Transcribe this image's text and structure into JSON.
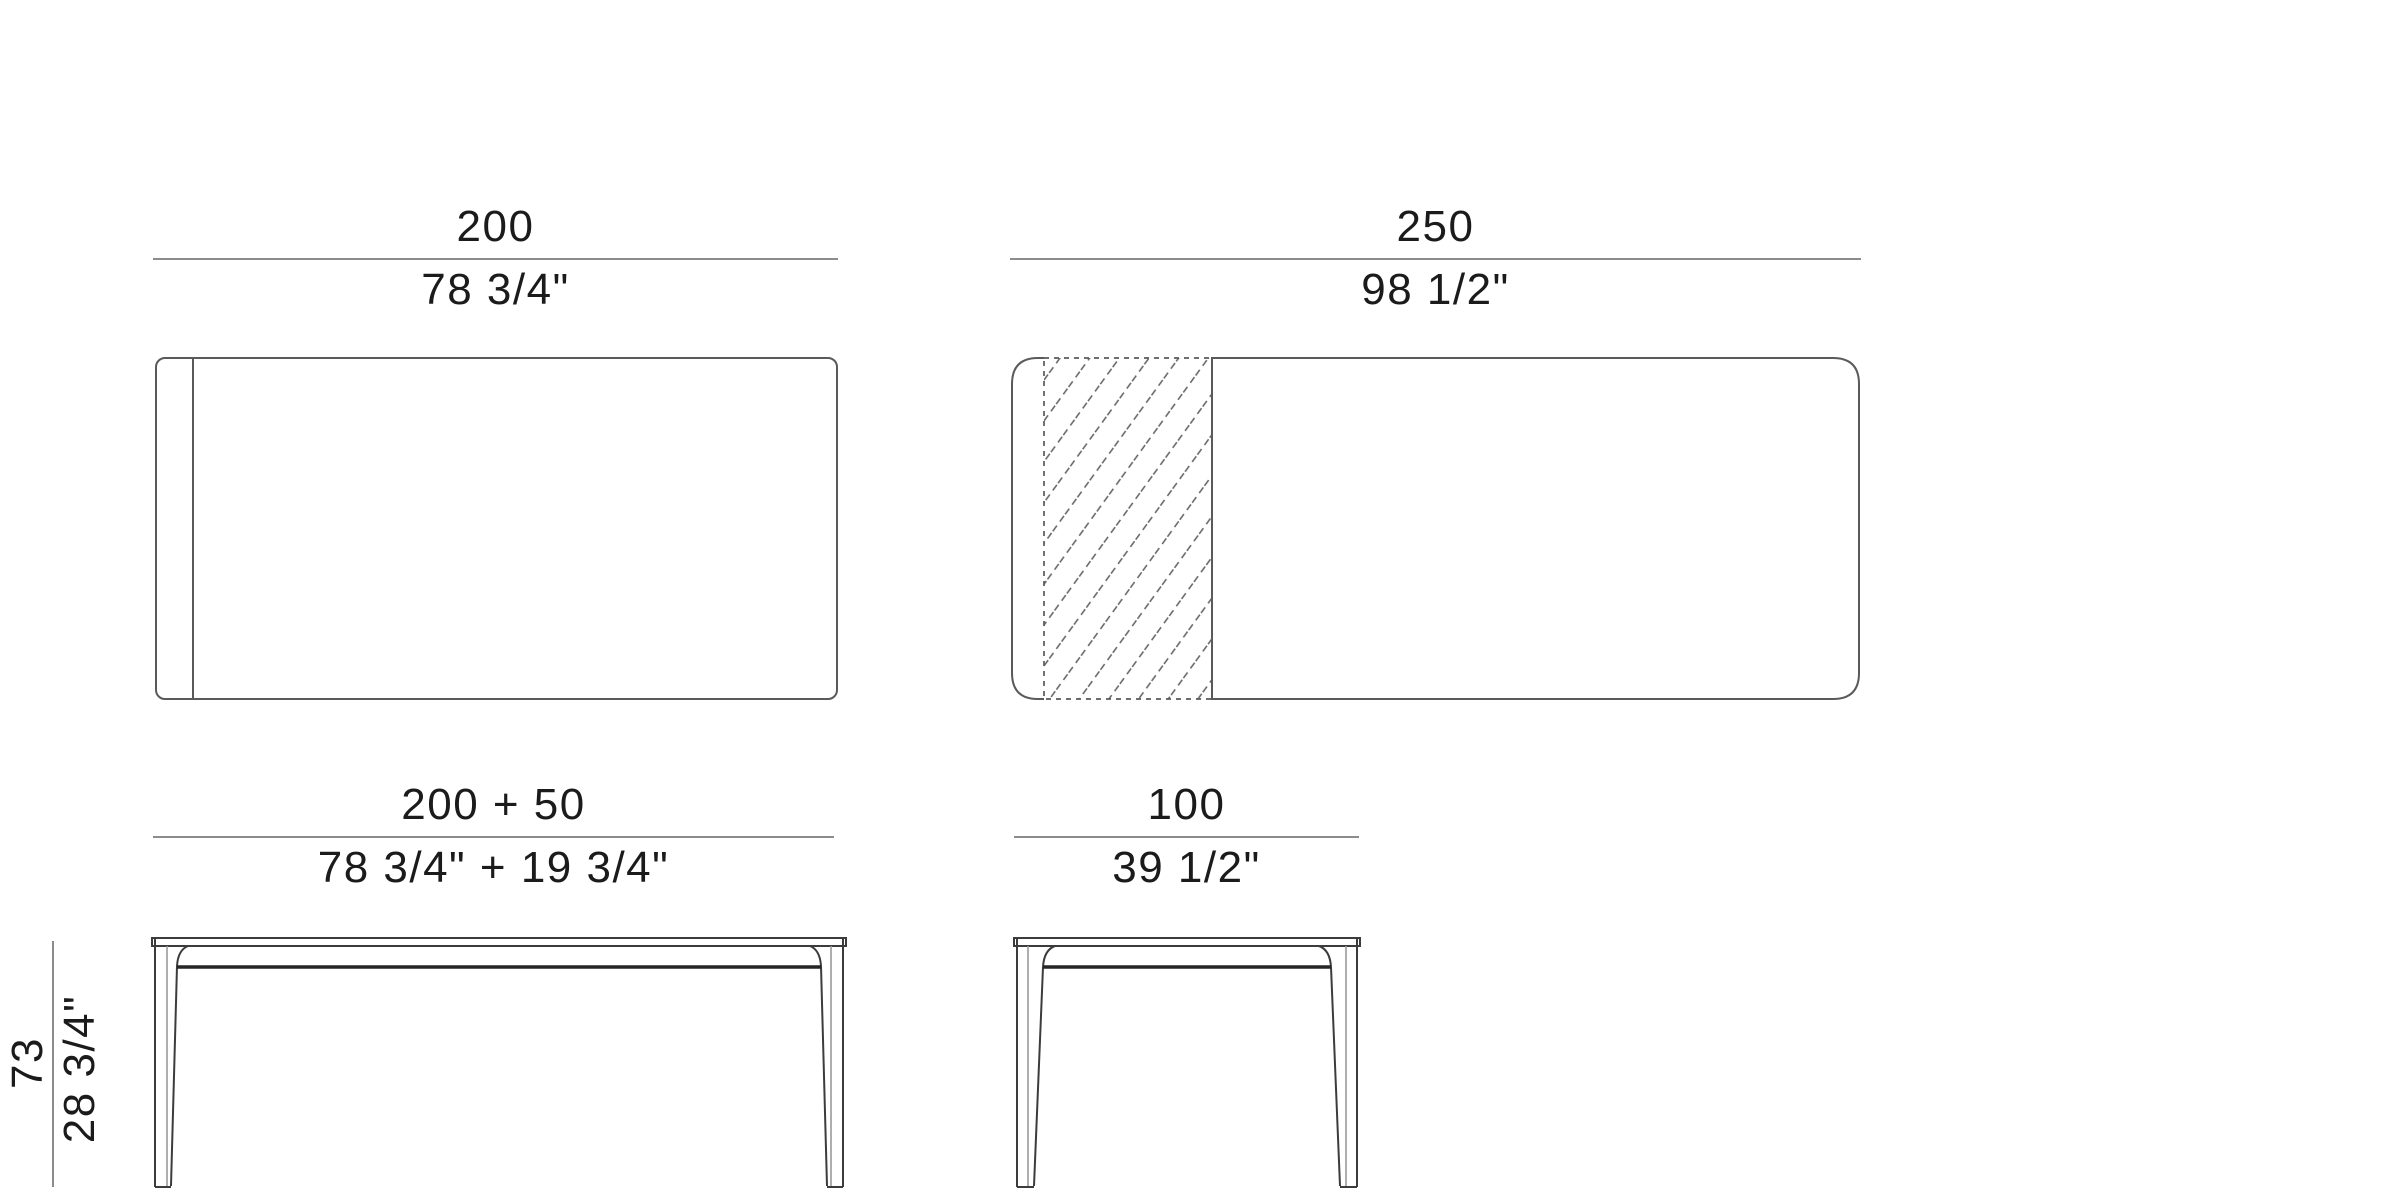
{
  "diagram": {
    "kind": "furniture technical drawing",
    "views": [
      {
        "id": "plan-view-closed",
        "label_cm": "200"
      },
      {
        "id": "plan-view-extended",
        "label_cm": "250"
      },
      {
        "id": "side-elevation",
        "label_cm": "200 + 50"
      },
      {
        "id": "end-elevation",
        "label_cm": "100"
      }
    ]
  },
  "dimensions": {
    "length_closed": {
      "cm": "200",
      "inches": "78 3/4\""
    },
    "length_extended": {
      "cm": "250",
      "inches": "98 1/2\""
    },
    "length_with_extension": {
      "cm": "200 + 50",
      "inches": "78 3/4\" + 19 3/4\""
    },
    "width": {
      "cm": "100",
      "inches": "39 1/2\""
    },
    "height": {
      "cm": "73",
      "inches": "28 3/4\""
    }
  },
  "colors": {
    "text": "#1b1b1b",
    "dim_line": "#8c8c8c",
    "plan_stroke": "#5a5a5a",
    "elev_stroke": "#3c3c3c",
    "elev_light": "#9a9a9a",
    "apron_stroke": "#262626",
    "hatch_stroke": "#5f5f5f",
    "bg": "#ffffff"
  }
}
